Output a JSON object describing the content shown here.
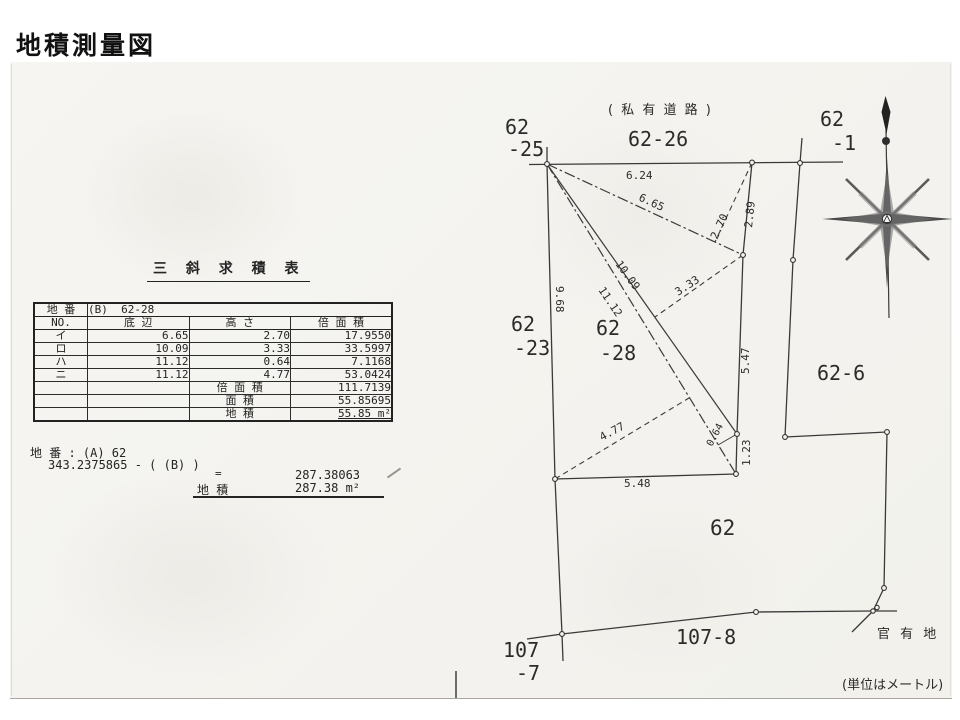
{
  "page_title": "地積測量図",
  "table_section": {
    "title": "三 斜 求 積 表",
    "parcel_label": "地 番",
    "parcel_value": "(B)  62-28",
    "headers": {
      "no": "NO.",
      "base": "底 辺",
      "height": "高 さ",
      "double_area": "倍 面 積"
    },
    "rows": [
      {
        "no": "イ",
        "base": "6.65",
        "height": "2.70",
        "double_area": "17.9550"
      },
      {
        "no": "ロ",
        "base": "10.09",
        "height": "3.33",
        "double_area": "33.5997"
      },
      {
        "no": "ハ",
        "base": "11.12",
        "height": "0.64",
        "double_area": "7.1168"
      },
      {
        "no": "ニ",
        "base": "11.12",
        "height": "4.77",
        "double_area": "53.0424"
      }
    ],
    "totals": [
      {
        "label": "倍 面 積",
        "value": "111.7139"
      },
      {
        "label": "面 積",
        "value": "55.85695"
      },
      {
        "label": "地 積",
        "value": "55.85 m²"
      }
    ]
  },
  "calc_section": {
    "line1": "地 番 : (A) 62",
    "line2": "343.2375865 - ( (B) )",
    "equals": "=",
    "result": "287.38063",
    "area_label": "地 積",
    "area_value": "287.38 m²"
  },
  "map": {
    "road_label": "( 私 有 道 路 )",
    "units_note": "(単位はメートル)",
    "gov_land_label": "官 有 地",
    "parcels": {
      "p62_25_a": "62",
      "p62_25_b": "-25",
      "p62_26": "62-26",
      "p62_1_a": "62",
      "p62_1_b": "-1",
      "p62_23_a": "62",
      "p62_23_b": "-23",
      "p62_28_a": "62",
      "p62_28_b": "-28",
      "p62_6": "62-6",
      "p62": "62",
      "p107_7_a": "107",
      "p107_7_b": "-7",
      "p107_8": "107-8"
    },
    "measurements": {
      "top_edge": "6.24",
      "tri_i_base": "6.65",
      "tri_i_height": "2.70",
      "ne_edge": "2.89",
      "diag_1": "10.09",
      "diag_2": "11.12",
      "tri_ro_height": "3.33",
      "west_edge": "9.68",
      "east_edge": "5.47",
      "tri_ni_height": "4.77",
      "tri_ha_height": "0.64",
      "se_edge": "1.23",
      "south_edge": "5.48"
    }
  }
}
